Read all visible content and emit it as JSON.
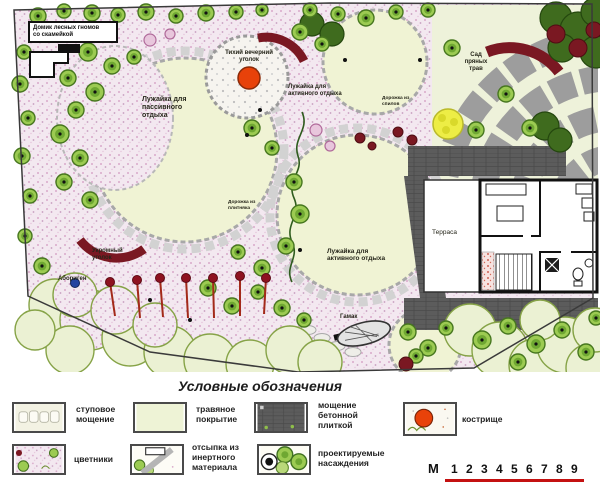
{
  "plan": {
    "labels": {
      "gnome_house": "Домик лесных гномов\nсо скамейкой",
      "fire_corner": "Тихий вечерний\nуголок",
      "lawn_passive": "Лужайка для\nпассивного\nотдыха",
      "lawn_active_upper": "Лужайка для\nактивного отдыха",
      "lawn_active_lower": "Лужайка для\nактивного отдыха",
      "herb_garden": "Сад\nпряных\nтрав",
      "secluded_corner": "Укромный\nуголок",
      "native_plant": "Абориген",
      "hammock": "Гамак",
      "terrace": "Терраса",
      "path_cuts": "Дорожка из\nспилов",
      "path_flag": "Дорожка из\nплитняка"
    }
  },
  "legend": {
    "title": "Условные обозначения",
    "items": [
      {
        "id": "stone-paving",
        "label": "ступовое\nмощение"
      },
      {
        "id": "grass-cover",
        "label": "травяное\nпокрытие"
      },
      {
        "id": "concrete-tile",
        "label": "мощение\nбетонной\nплиткой"
      },
      {
        "id": "firepit",
        "label": "кострище"
      },
      {
        "id": "flowerbeds",
        "label": "цветники"
      },
      {
        "id": "inert-fill",
        "label": "отсыпка из\nинертного\nматериала"
      },
      {
        "id": "plantings",
        "label": "проектируемые\nнасаждения"
      }
    ],
    "scale": {
      "prefix": "М",
      "ticks": [
        "1",
        "2",
        "3",
        "4",
        "5",
        "6",
        "7",
        "8",
        "9"
      ]
    }
  },
  "colors": {
    "lawn": "#f0f3d4",
    "path_pink": "#f3e8f0",
    "concrete": "#5c5c5c",
    "tree_green": "#9ccb52",
    "fire_orange": "#e8420a",
    "maroon": "#7a1822",
    "scale_red": "#c41111"
  }
}
